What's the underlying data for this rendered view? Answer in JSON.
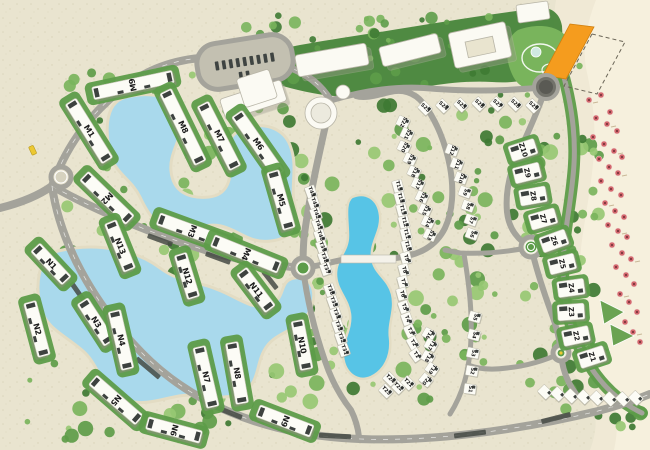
{
  "map": {
    "colors": {
      "sand": "#e9e4cf",
      "sand_speckle": "#d8d2b6",
      "beach": "#f0e9d5",
      "beach_light": "#f6f0dd",
      "road": "#a4a39b",
      "road_line": "#ffffff",
      "lagoon": "#a9d9ec",
      "lagoon_bright": "#57c4e6",
      "lagoon_rim": "#e3dcc3",
      "green_dark": "#3e7a33",
      "green": "#5d9c49",
      "green_light": "#79b45c",
      "green_pale": "#97c873",
      "building_white": "#fcfcf6",
      "building_shadow": "#8f8d80",
      "roof_accent": "#3d423f",
      "label": "#1a1a1a",
      "highlight_orange": "#f59c1e",
      "umbrella_red": "#d4686e",
      "marker_yellow": "#ecc832"
    },
    "apartment_buildings": [
      [
        "M9",
        133,
        85,
        82,
        -12
      ],
      [
        "M1",
        89,
        131,
        70,
        58
      ],
      [
        "M8",
        183,
        127,
        80,
        64
      ],
      [
        "M7",
        219,
        136,
        72,
        63
      ],
      [
        "M6",
        258,
        144,
        74,
        55
      ],
      [
        "M2",
        107,
        198,
        64,
        44
      ],
      [
        "M5",
        281,
        200,
        60,
        74
      ],
      [
        "M3",
        192,
        231,
        72,
        20
      ],
      [
        "M4",
        246,
        254,
        72,
        22
      ],
      [
        "N13",
        120,
        246,
        52,
        68
      ],
      [
        "N1",
        51,
        264,
        46,
        47
      ],
      [
        "N12",
        187,
        276,
        46,
        73
      ],
      [
        "N11",
        256,
        290,
        48,
        53
      ],
      [
        "N2",
        37,
        329,
        56,
        75
      ],
      [
        "N3",
        96,
        322,
        50,
        57
      ],
      [
        "N4",
        121,
        340,
        60,
        77
      ],
      [
        "N10",
        302,
        345,
        50,
        79
      ],
      [
        "N5",
        116,
        400,
        62,
        41
      ],
      [
        "N7",
        206,
        377,
        62,
        77
      ],
      [
        "N8",
        237,
        373,
        62,
        80
      ],
      [
        "N9",
        285,
        421,
        58,
        21
      ],
      [
        "N6",
        174,
        430,
        56,
        15
      ]
    ],
    "beach_villas": [
      [
        "Z10",
        523,
        150,
        -18
      ],
      [
        "Z9",
        527,
        173,
        -14
      ],
      [
        "Z8",
        533,
        196,
        -10
      ],
      [
        "Z7",
        543,
        219,
        -16
      ],
      [
        "Z6",
        554,
        241,
        -20
      ],
      [
        "Z5",
        562,
        264,
        -14
      ],
      [
        "Z4",
        571,
        288,
        -8
      ],
      [
        "Z3",
        571,
        312,
        -4
      ],
      [
        "Z2",
        576,
        336,
        -12
      ],
      [
        "Z1",
        592,
        357,
        -18
      ]
    ],
    "chalets": [
      [
        "S23",
        425,
        108,
        45
      ],
      [
        "S24",
        443,
        106,
        45
      ],
      [
        "S25",
        461,
        105,
        45
      ],
      [
        "S26",
        479,
        104,
        45
      ],
      [
        "S27",
        497,
        104,
        45
      ],
      [
        "S28",
        515,
        104,
        45
      ],
      [
        "S29",
        533,
        106,
        45
      ],
      [
        "S22",
        403,
        122,
        25
      ],
      [
        "S21",
        407,
        134,
        25
      ],
      [
        "S20",
        404,
        147,
        25
      ],
      [
        "S19",
        410,
        159,
        25
      ],
      [
        "S18",
        414,
        172,
        25
      ],
      [
        "S17",
        418,
        184,
        25
      ],
      [
        "S16",
        422,
        197,
        25
      ],
      [
        "S15",
        425,
        210,
        25
      ],
      [
        "S14",
        428,
        222,
        25
      ],
      [
        "S13",
        430,
        235,
        25
      ],
      [
        "S12",
        452,
        150,
        20
      ],
      [
        "S11",
        457,
        164,
        20
      ],
      [
        "S10",
        461,
        178,
        20
      ],
      [
        "S9",
        465,
        192,
        20
      ],
      [
        "S8",
        468,
        206,
        20
      ],
      [
        "S7",
        471,
        220,
        20
      ],
      [
        "S6",
        472,
        234,
        20
      ],
      [
        "S5",
        475,
        317,
        15
      ],
      [
        "S4",
        474,
        335,
        15
      ],
      [
        "S3",
        473,
        353,
        12
      ],
      [
        "S2",
        472,
        371,
        10
      ],
      [
        "S1",
        470,
        389,
        8
      ],
      [
        "T44",
        311,
        192,
        70
      ],
      [
        "T43",
        314,
        203,
        70
      ],
      [
        "T42",
        316,
        214,
        70
      ],
      [
        "T41",
        318,
        225,
        70
      ],
      [
        "T40",
        320,
        236,
        70
      ],
      [
        "T39",
        322,
        247,
        70
      ],
      [
        "T38",
        324,
        258,
        70
      ],
      [
        "T37",
        326,
        269,
        70
      ],
      [
        "T36",
        330,
        290,
        70
      ],
      [
        "T35",
        333,
        302,
        70
      ],
      [
        "T34",
        336,
        314,
        70
      ],
      [
        "T33",
        338,
        326,
        70
      ],
      [
        "T32",
        341,
        338,
        70
      ],
      [
        "T31",
        344,
        350,
        70
      ],
      [
        "T15",
        398,
        186,
        75
      ],
      [
        "T14",
        400,
        198,
        75
      ],
      [
        "T13",
        402,
        210,
        75
      ],
      [
        "T12",
        404,
        222,
        75
      ],
      [
        "T11",
        406,
        234,
        75
      ],
      [
        "T10",
        407,
        246,
        75
      ],
      [
        "T9",
        406,
        258,
        75
      ],
      [
        "T8",
        404,
        270,
        75
      ],
      [
        "T7",
        403,
        282,
        75
      ],
      [
        "T6",
        402,
        294,
        75
      ],
      [
        "T5",
        404,
        307,
        70
      ],
      [
        "T4",
        407,
        319,
        70
      ],
      [
        "T3",
        410,
        331,
        65
      ],
      [
        "T2",
        413,
        343,
        60
      ],
      [
        "T1",
        416,
        355,
        55
      ],
      [
        "T16",
        429,
        334,
        30
      ],
      [
        "T17",
        431,
        345,
        30
      ],
      [
        "T18",
        428,
        357,
        30
      ],
      [
        "T19",
        432,
        369,
        35
      ],
      [
        "T20",
        426,
        380,
        40
      ],
      [
        "T21",
        408,
        383,
        45
      ],
      [
        "T22",
        398,
        387,
        45
      ],
      [
        "T23",
        386,
        391,
        45
      ],
      [
        "T24",
        390,
        379,
        45
      ]
    ],
    "chalets_unlabeled": [
      [
        545,
        392,
        45
      ],
      [
        558,
        394,
        45
      ],
      [
        571,
        396,
        45
      ],
      [
        584,
        397,
        45
      ],
      [
        597,
        398,
        45
      ],
      [
        610,
        399,
        45
      ],
      [
        623,
        399,
        45
      ],
      [
        636,
        398,
        45
      ]
    ],
    "umbrellas": [
      [
        589,
        100
      ],
      [
        601,
        95
      ],
      [
        610,
        112
      ],
      [
        596,
        118
      ],
      [
        607,
        124
      ],
      [
        617,
        131
      ],
      [
        593,
        137
      ],
      [
        604,
        144
      ],
      [
        614,
        151
      ],
      [
        622,
        157
      ],
      [
        599,
        159
      ],
      [
        609,
        167
      ],
      [
        618,
        173
      ],
      [
        601,
        181
      ],
      [
        611,
        189
      ],
      [
        621,
        195
      ],
      [
        605,
        203
      ],
      [
        615,
        211
      ],
      [
        624,
        217
      ],
      [
        608,
        225
      ],
      [
        618,
        231
      ],
      [
        627,
        237
      ],
      [
        612,
        245
      ],
      [
        622,
        253
      ],
      [
        631,
        259
      ],
      [
        616,
        267
      ],
      [
        626,
        275
      ],
      [
        634,
        284
      ],
      [
        620,
        294
      ],
      [
        629,
        302
      ],
      [
        637,
        312
      ],
      [
        625,
        322
      ],
      [
        633,
        332
      ],
      [
        640,
        342
      ]
    ],
    "roundabouts": [
      [
        61,
        177,
        10,
        "ring"
      ],
      [
        303,
        268,
        10,
        "green"
      ],
      [
        531,
        247,
        10,
        "pattern"
      ],
      [
        546,
        87,
        12,
        "dark"
      ],
      [
        561,
        353,
        8,
        "mini"
      ]
    ],
    "shade_strips": [
      [
        80,
        295,
        30,
        55
      ],
      [
        148,
        368,
        30,
        40
      ],
      [
        228,
        412,
        30,
        22
      ],
      [
        335,
        436,
        32,
        3
      ],
      [
        470,
        434,
        32,
        -7
      ],
      [
        556,
        418,
        30,
        -14
      ],
      [
        218,
        258,
        26,
        20
      ],
      [
        160,
        240,
        26,
        20
      ],
      [
        270,
        280,
        22,
        52
      ]
    ]
  }
}
